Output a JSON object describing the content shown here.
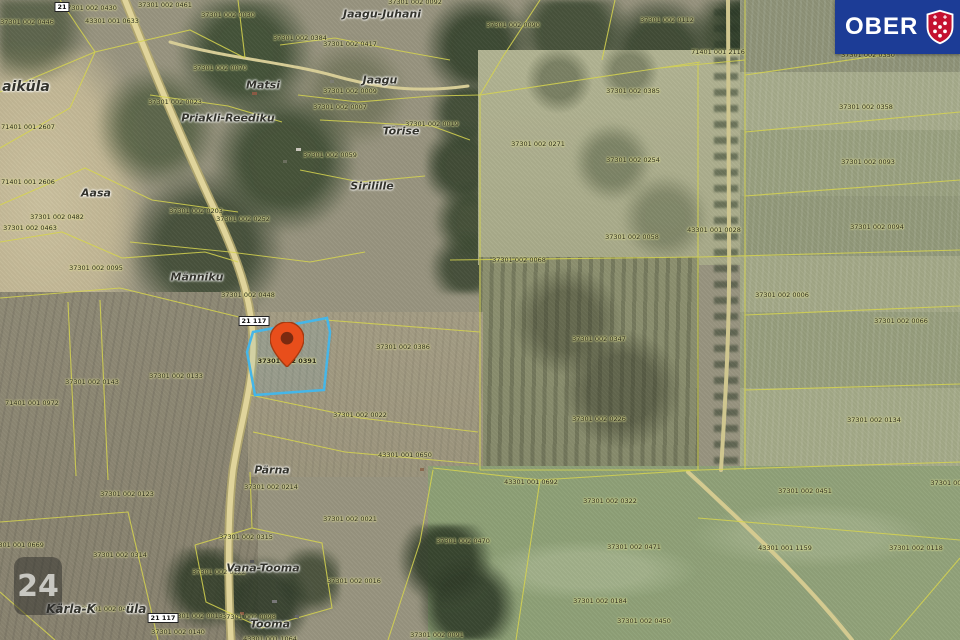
{
  "map": {
    "branding": {
      "logo_text_left": "OBER",
      "logo_text_right": "HA",
      "logo_bg": "#1c3c96",
      "shield_color": "#c41230",
      "watermark": "24"
    },
    "selected_parcel": {
      "label": "37301 002 0391",
      "outline_color": "#45b6e8",
      "pin_color": "#e84e1b"
    },
    "road_badges": [
      {
        "text": "21",
        "x": 62,
        "y": 7
      },
      {
        "text": "21 117",
        "x": 254,
        "y": 321
      },
      {
        "text": "21 117",
        "x": 163,
        "y": 618
      }
    ],
    "place_names": [
      {
        "text": "Jaagu-Juhani",
        "x": 382,
        "y": 14
      },
      {
        "text": "Jaagu",
        "x": 380,
        "y": 80
      },
      {
        "text": "Matsi",
        "x": 263,
        "y": 85
      },
      {
        "text": "Tõrise",
        "x": 401,
        "y": 131
      },
      {
        "text": "Sirilille",
        "x": 372,
        "y": 186
      },
      {
        "text": "Priakli-Reediku",
        "x": 228,
        "y": 118
      },
      {
        "text": "Aasa",
        "x": 96,
        "y": 193
      },
      {
        "text": "Männiku",
        "x": 197,
        "y": 277
      },
      {
        "text": "aiküla",
        "x": 26,
        "y": 87,
        "size": 14
      },
      {
        "text": "Pärna",
        "x": 272,
        "y": 470
      },
      {
        "text": "Vana-Tooma",
        "x": 263,
        "y": 568
      },
      {
        "text": "Tooma",
        "x": 270,
        "y": 624
      },
      {
        "text": "Kärla-K",
        "x": 71,
        "y": 609,
        "size": 12
      },
      {
        "text": "üla",
        "x": 136,
        "y": 609,
        "size": 12
      }
    ],
    "parcel_labels": [
      {
        "text": "37301 002 0430",
        "x": 90,
        "y": 8
      },
      {
        "text": "37301 002 0461",
        "x": 165,
        "y": 5
      },
      {
        "text": "37301 002 0030",
        "x": 228,
        "y": 15
      },
      {
        "text": "37301 002 0446",
        "x": 27,
        "y": 22
      },
      {
        "text": "43301 001 0633",
        "x": 112,
        "y": 21
      },
      {
        "text": "37301 002 0384",
        "x": 300,
        "y": 38
      },
      {
        "text": "37301 002 0092",
        "x": 415,
        "y": 2
      },
      {
        "text": "37301 002 0417",
        "x": 350,
        "y": 44
      },
      {
        "text": "37301 002 0009",
        "x": 350,
        "y": 91
      },
      {
        "text": "37301 002 0007",
        "x": 340,
        "y": 107
      },
      {
        "text": "37301 002 0090",
        "x": 513,
        "y": 25
      },
      {
        "text": "37301 002 0112",
        "x": 667,
        "y": 20
      },
      {
        "text": "71401 001 2116",
        "x": 718,
        "y": 52
      },
      {
        "text": "37301 002 0385",
        "x": 633,
        "y": 91
      },
      {
        "text": "37301 002 0350",
        "x": 868,
        "y": 55
      },
      {
        "text": "37301 002 0358",
        "x": 866,
        "y": 107
      },
      {
        "text": "37301 002 0271",
        "x": 538,
        "y": 144
      },
      {
        "text": "37301 002 0254",
        "x": 633,
        "y": 160
      },
      {
        "text": "37301 002 0093",
        "x": 868,
        "y": 162
      },
      {
        "text": "37301 002 0094",
        "x": 877,
        "y": 227
      },
      {
        "text": "43301 001 0028",
        "x": 714,
        "y": 230
      },
      {
        "text": "37301 002 0058",
        "x": 632,
        "y": 237
      },
      {
        "text": "37301 002 0068",
        "x": 519,
        "y": 260
      },
      {
        "text": "37301 002 0006",
        "x": 782,
        "y": 295
      },
      {
        "text": "37301 002 0066",
        "x": 901,
        "y": 321
      },
      {
        "text": "71401 001 2607",
        "x": 28,
        "y": 127
      },
      {
        "text": "71401 001 2606",
        "x": 28,
        "y": 182
      },
      {
        "text": "37301 002 0482",
        "x": 57,
        "y": 217
      },
      {
        "text": "37301 002 0463",
        "x": 30,
        "y": 228
      },
      {
        "text": "37301 002 0095",
        "x": 96,
        "y": 268
      },
      {
        "text": "37301 002 0203",
        "x": 196,
        "y": 211
      },
      {
        "text": "37301 002 0252",
        "x": 243,
        "y": 219
      },
      {
        "text": "37301 002 0448",
        "x": 248,
        "y": 295
      },
      {
        "text": "37301 002 0059",
        "x": 330,
        "y": 155
      },
      {
        "text": "37301 002 0019",
        "x": 432,
        "y": 124
      },
      {
        "text": "37301 002 0023",
        "x": 175,
        "y": 102
      },
      {
        "text": "37301 002 0070",
        "x": 220,
        "y": 68
      },
      {
        "text": "37301 002 0386",
        "x": 403,
        "y": 347
      },
      {
        "text": "37301 002 0133",
        "x": 176,
        "y": 376
      },
      {
        "text": "37301 002 0143",
        "x": 92,
        "y": 382
      },
      {
        "text": "71401 001 0972",
        "x": 32,
        "y": 403
      },
      {
        "text": "37301 002 0022",
        "x": 360,
        "y": 415
      },
      {
        "text": "43301 001 0650",
        "x": 405,
        "y": 455
      },
      {
        "text": "37301 002 0347",
        "x": 599,
        "y": 339
      },
      {
        "text": "37301 002 0226",
        "x": 599,
        "y": 419
      },
      {
        "text": "37301 002 0134",
        "x": 874,
        "y": 420
      },
      {
        "text": "37301 002 0451",
        "x": 805,
        "y": 491
      },
      {
        "text": "37301 002",
        "x": 948,
        "y": 483
      },
      {
        "text": "43301 001 1159",
        "x": 785,
        "y": 548
      },
      {
        "text": "37301 002 0118",
        "x": 916,
        "y": 548
      },
      {
        "text": "43301 001 0692",
        "x": 531,
        "y": 482
      },
      {
        "text": "37301 002 0322",
        "x": 610,
        "y": 501
      },
      {
        "text": "37301 002 0470",
        "x": 463,
        "y": 541
      },
      {
        "text": "37301 002 0471",
        "x": 634,
        "y": 547
      },
      {
        "text": "37301 002 0184",
        "x": 600,
        "y": 601
      },
      {
        "text": "37301 002 0450",
        "x": 644,
        "y": 621
      },
      {
        "text": "37301 002 0016",
        "x": 354,
        "y": 581
      },
      {
        "text": "37301 002 0091",
        "x": 437,
        "y": 635
      },
      {
        "text": "37301 001 0669",
        "x": 17,
        "y": 545
      },
      {
        "text": "37301 002 0314",
        "x": 120,
        "y": 555
      },
      {
        "text": "37301 002 0122",
        "x": 219,
        "y": 572
      },
      {
        "text": "37301 002 0315",
        "x": 246,
        "y": 537
      },
      {
        "text": "37301 002 0021",
        "x": 350,
        "y": 519
      },
      {
        "text": "37301 002 0214",
        "x": 271,
        "y": 487
      },
      {
        "text": "37301 002 0123",
        "x": 127,
        "y": 494
      },
      {
        "text": "37301 002 0404",
        "x": 108,
        "y": 609
      },
      {
        "text": "37301 002 0013",
        "x": 196,
        "y": 616
      },
      {
        "text": "37301 002 0140",
        "x": 178,
        "y": 632
      },
      {
        "text": "37301 002 0098",
        "x": 249,
        "y": 617
      },
      {
        "text": "43301 001 1064",
        "x": 270,
        "y": 639
      }
    ]
  }
}
